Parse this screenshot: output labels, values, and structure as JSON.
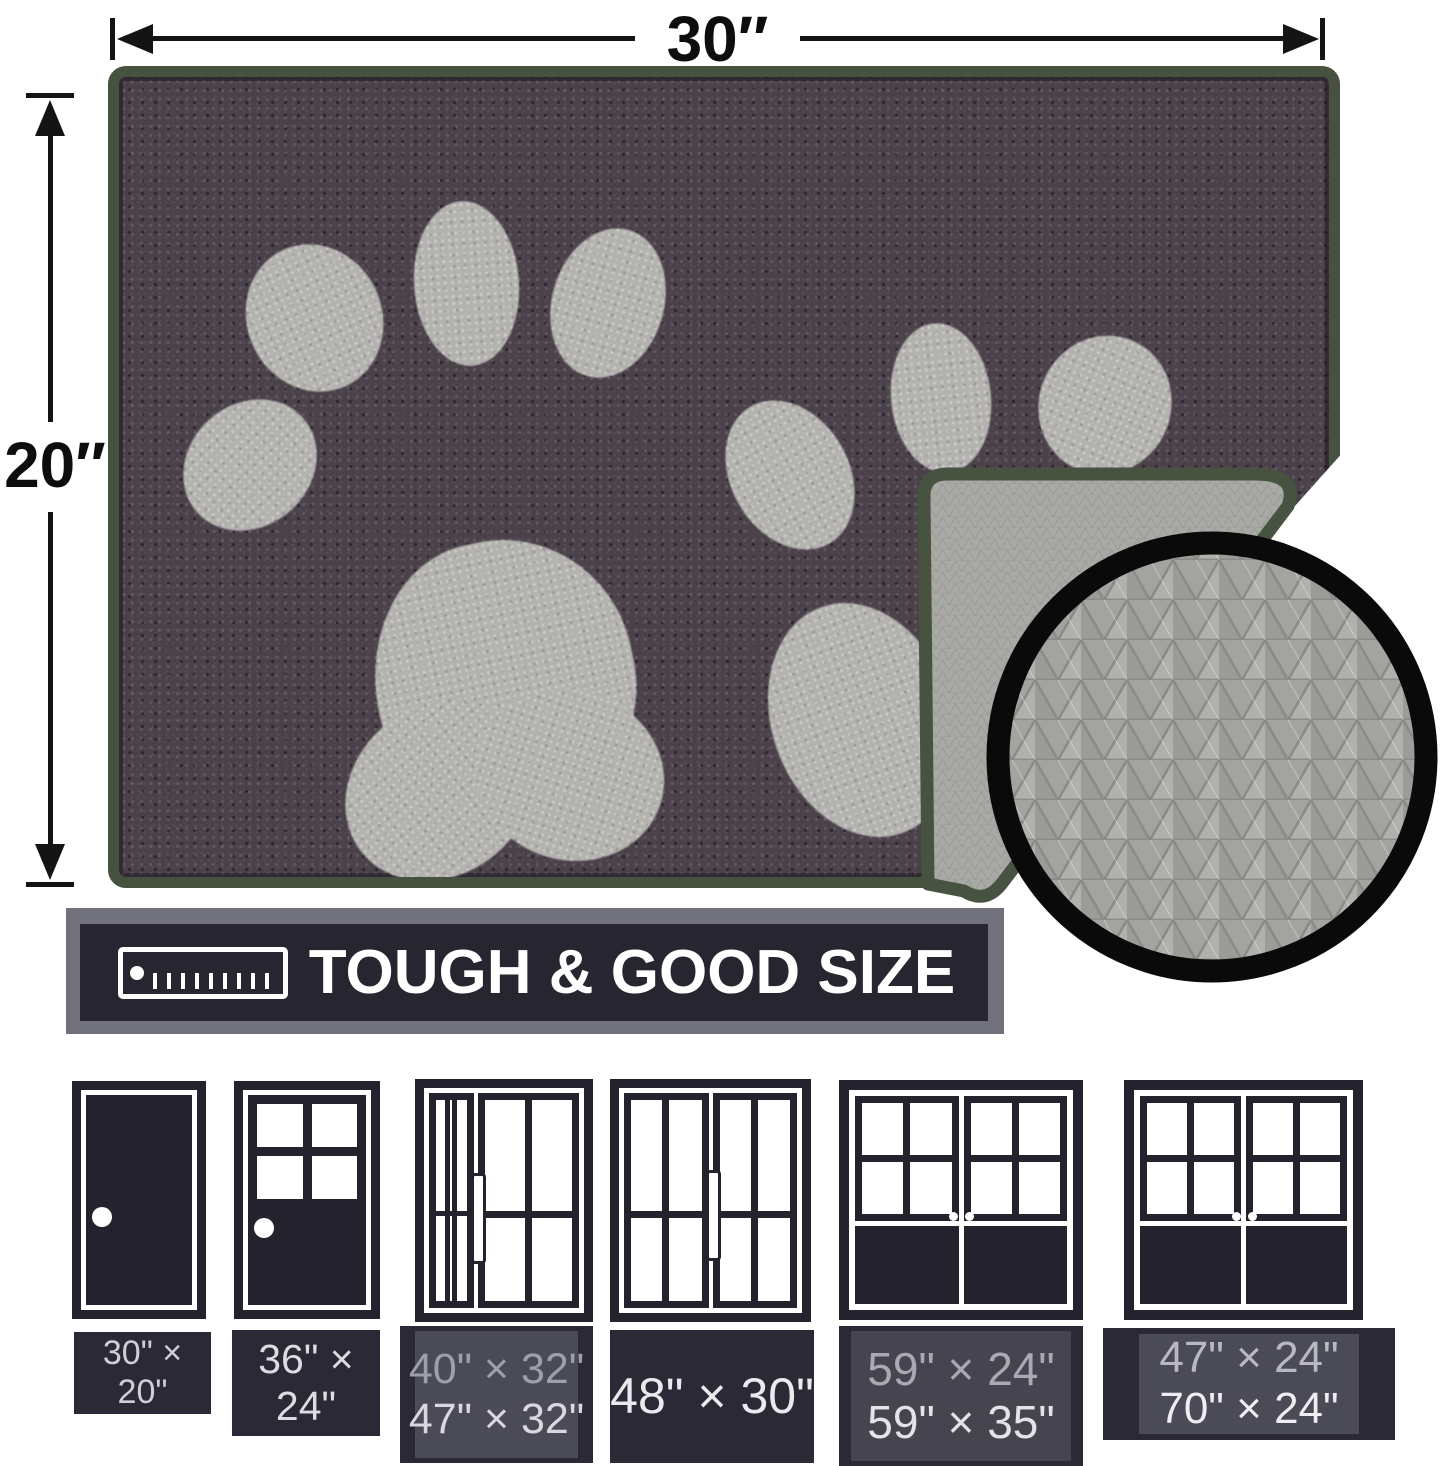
{
  "dimensions": {
    "width": "30″",
    "height": "20″"
  },
  "banner": {
    "title": "TOUGH & GOOD SIZE"
  },
  "sizes": [
    {
      "lines": [
        "30\" × 20\"",
        ""
      ]
    },
    {
      "lines": [
        "36\" × 24\"",
        ""
      ]
    },
    {
      "lines": [
        "40\" × 32\"",
        "47\" × 32\""
      ]
    },
    {
      "lines": [
        "48\" × 30\"",
        ""
      ]
    },
    {
      "lines": [
        "59\" × 24\"",
        "59\" × 35\""
      ]
    },
    {
      "lines": [
        "47\" × 24\"",
        "70\" × 24\""
      ]
    }
  ],
  "colors": {
    "mat_fur": "#4a4149",
    "paw_print": "#b3b2af",
    "edge_binding": "#46513f",
    "backing_gray": "#a8a9a4",
    "inset_ring": "#0a0a0a",
    "banner_bg": "#262530",
    "banner_shadow": "#71717b",
    "label_bg": "#2a2935",
    "label_inner": "#4b4a57",
    "door_icon": "#23222d",
    "dimension_line": "#141414"
  }
}
